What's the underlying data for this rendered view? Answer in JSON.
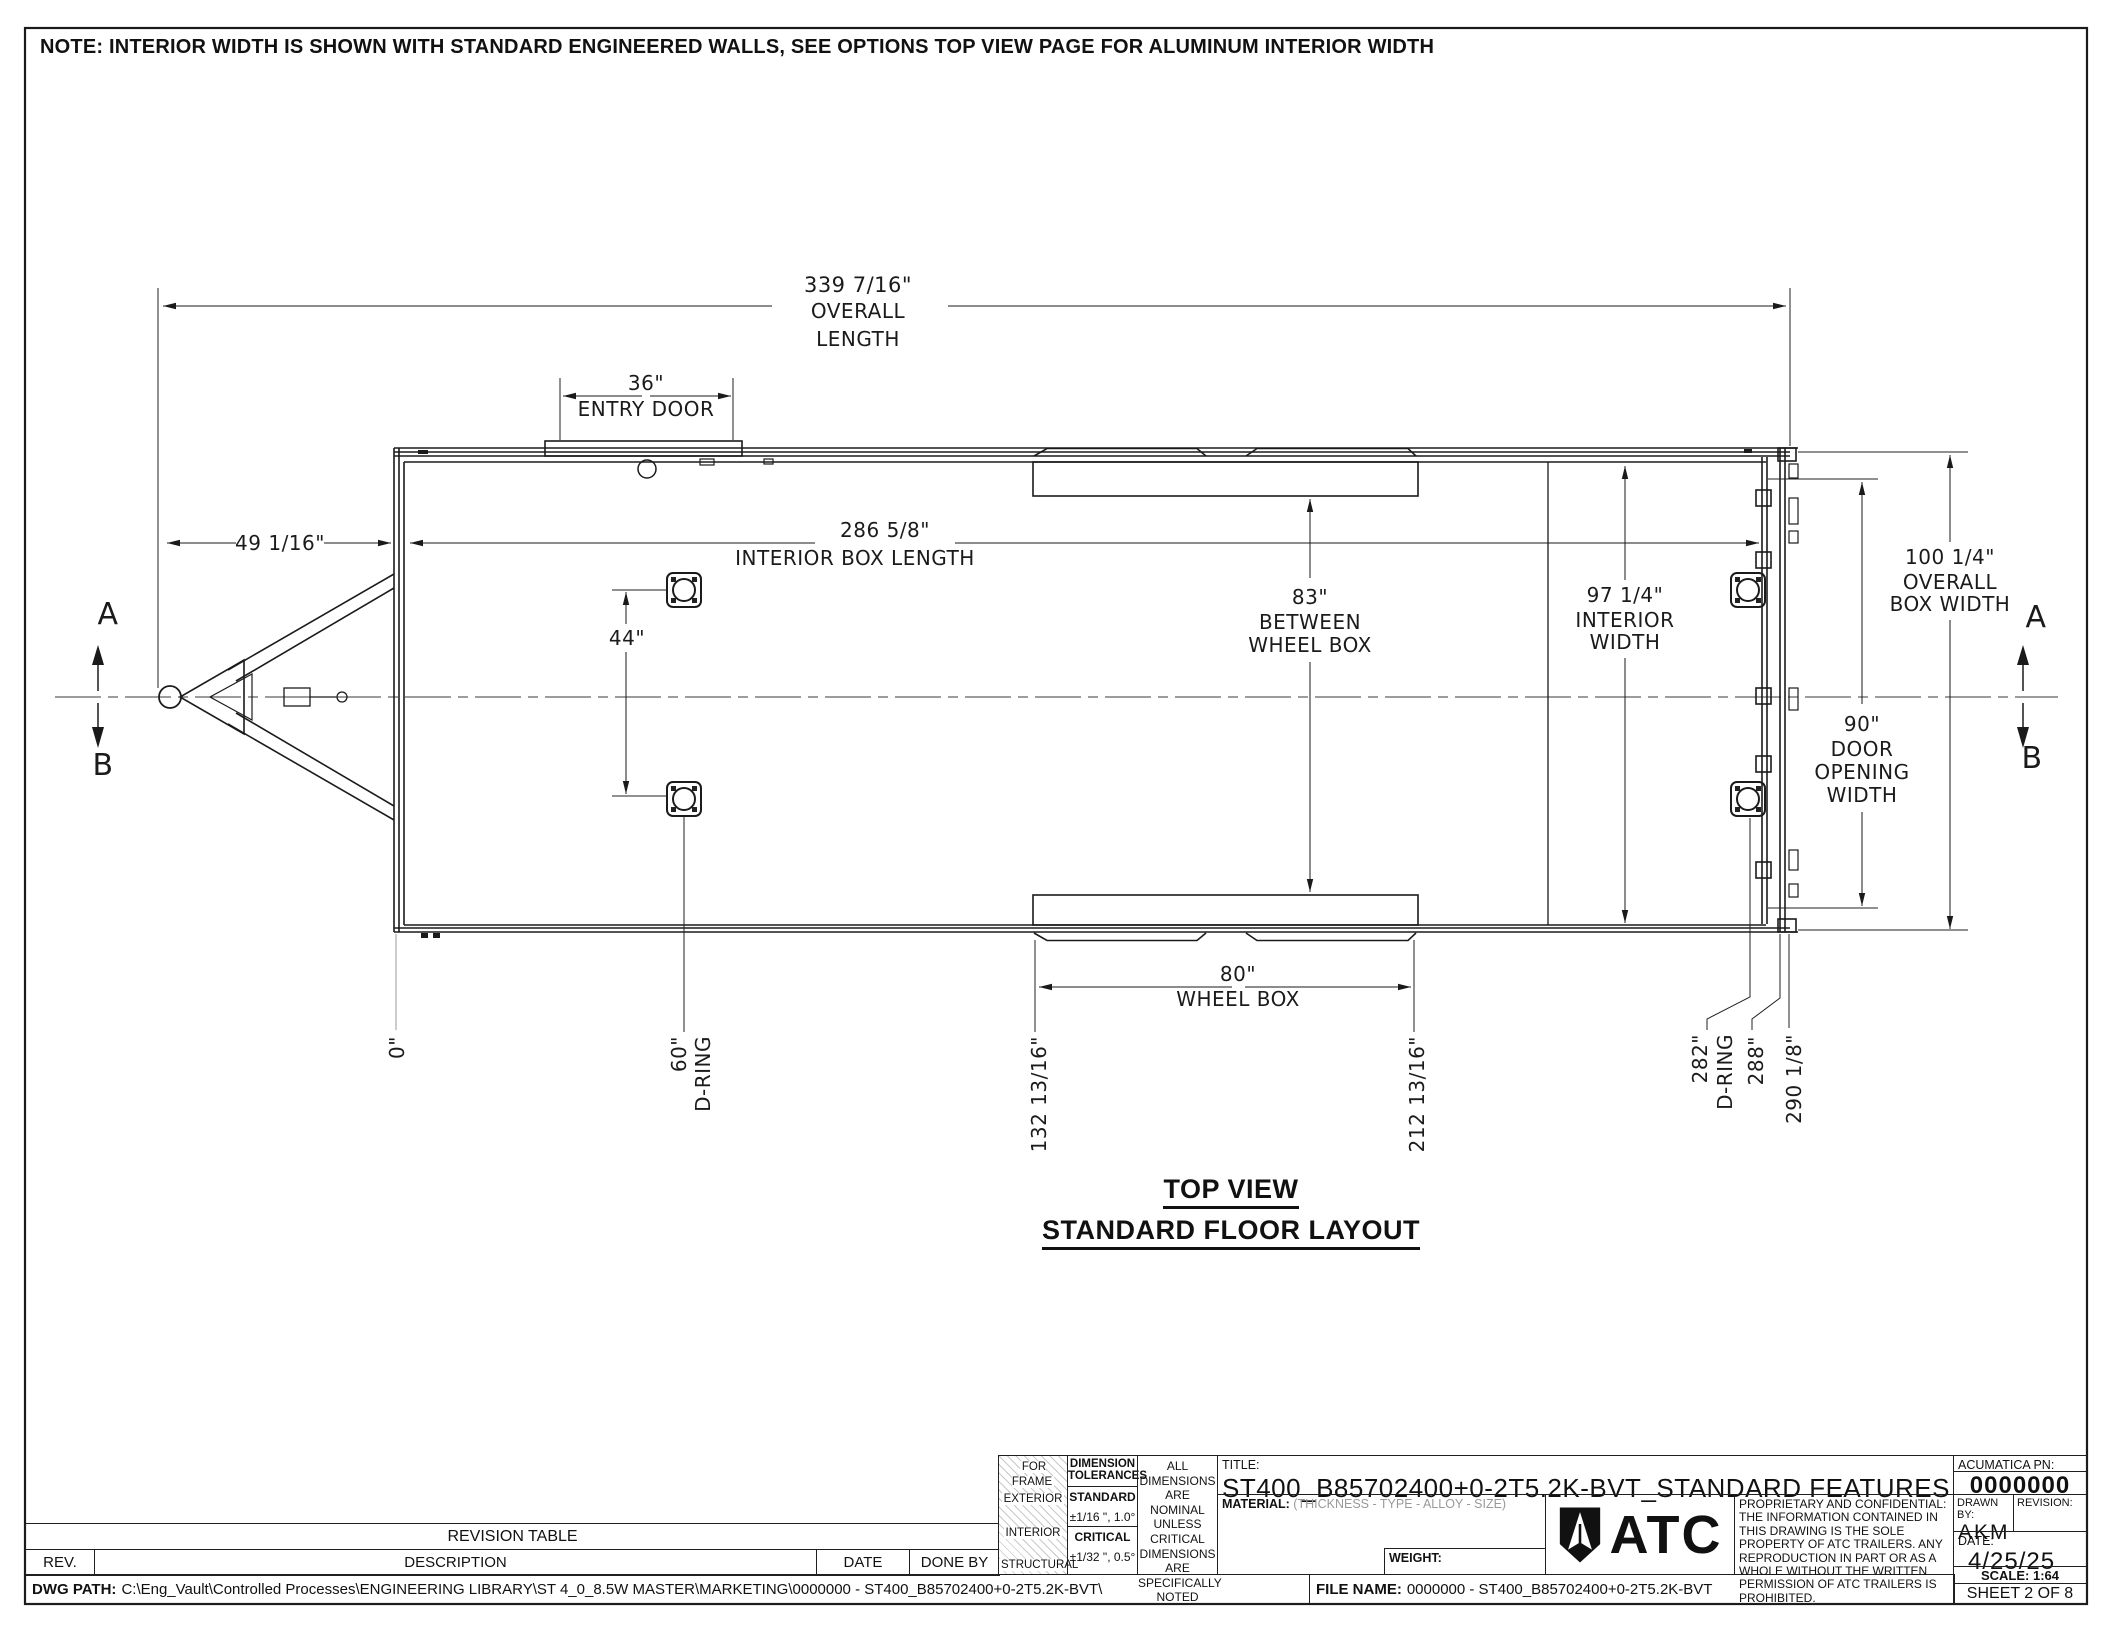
{
  "sheet": {
    "note": "NOTE: INTERIOR WIDTH IS SHOWN WITH STANDARD ENGINEERED WALLS, SEE OPTIONS TOP VIEW PAGE FOR ALUMINUM INTERIOR WIDTH",
    "view_title_line1": "TOP VIEW",
    "view_title_line2": "STANDARD FLOOR LAYOUT"
  },
  "sections": {
    "a": "A",
    "b": "B"
  },
  "dims": {
    "overall_length_value": "339 7/16\"",
    "overall_length_label1": "OVERALL",
    "overall_length_label2": "LENGTH",
    "entry_door_value": "36\"",
    "entry_door_label": "ENTRY DOOR",
    "tongue_value": "49 1/16\"",
    "interior_length_value": "286 5/8\"",
    "interior_length_label": "INTERIOR BOX LENGTH",
    "dring_span_value": "44\"",
    "between_wheelbox_value": "83\"",
    "between_wheelbox_label1": "BETWEEN",
    "between_wheelbox_label2": "WHEEL BOX",
    "interior_width_value": "97 1/4\"",
    "interior_width_label1": "INTERIOR",
    "interior_width_label2": "WIDTH",
    "overall_width_value": "100 1/4\"",
    "overall_width_label1": "OVERALL",
    "overall_width_label2": "BOX WIDTH",
    "door_opening_value": "90\"",
    "door_opening_label1": "DOOR",
    "door_opening_label2": "OPENING",
    "door_opening_label3": "WIDTH",
    "wheelbox_value": "80\"",
    "wheelbox_label": "WHEEL BOX",
    "sta_zero": "0\"",
    "sta_dring_front_value": "60\"",
    "sta_dring_front_label": "D-RING",
    "sta_wheelbox_front": "132 13/16\"",
    "sta_wheelbox_rear": "212 13/16\"",
    "sta_dring_rear_value": "282\"",
    "sta_dring_rear_label": "D-RING",
    "sta_288": "288\"",
    "sta_290": "290 1/8\""
  },
  "revision_table": {
    "title": "REVISION TABLE",
    "col_rev": "REV.",
    "col_desc": "DESCRIPTION",
    "col_date": "DATE",
    "col_done": "DONE BY"
  },
  "footer": {
    "dwg_path_label": "DWG PATH:",
    "dwg_path_value": "C:\\Eng_Vault\\Controlled Processes\\ENGINEERING LIBRARY\\ST 4_0_8.5W MASTER\\MARKETING\\0000000 - ST400_B85702400+0-2T5.2K-BVT\\",
    "file_name_label": "FILE NAME:",
    "file_name_value": "0000000 - ST400_B85702400+0-2T5.2K-BVT",
    "sheet_label": "SHEET 2 OF 8"
  },
  "title_block": {
    "for_frame": "FOR FRAME",
    "frame_row1": "EXTERIOR",
    "frame_row2": "INTERIOR",
    "frame_row3": "STRUCTURAL",
    "tol_header": "DIMENSION TOLERANCES",
    "standard_label": "STANDARD",
    "standard_value": "±1/16 \", 1.0°",
    "critical_label": "CRITICAL",
    "critical_value": "±1/32 \", 0.5°",
    "nominal_note": "ALL DIMENSIONS ARE NOMINAL UNLESS CRITICAL DIMENSIONS ARE SPECIFICALLY NOTED",
    "title_label": "TITLE:",
    "title_value": "ST400_B85702400+0-2T5.2K-BVT_STANDARD FEATURES",
    "material_label": "MATERIAL:",
    "material_value": "(THICKNESS - TYPE - ALLOY - SIZE)",
    "weight_label": "WEIGHT:",
    "logo_text": "ATC",
    "proprietary": "PROPRIETARY AND CONFIDENTIAL: THE INFORMATION CONTAINED IN THIS DRAWING IS THE SOLE PROPERTY OF ATC TRAILERS. ANY REPRODUCTION IN PART OR AS A WHOLE WITHOUT THE WRITTEN PERMISSION OF ATC TRAILERS IS PROHIBITED.",
    "acumatica_label": "ACUMATICA PN:",
    "acumatica_value": "0000000",
    "drawn_by_label": "DRAWN BY:",
    "drawn_by_value": "AKM",
    "revision_label": "REVISION:",
    "date_label": "DATE:",
    "date_value": "4/25/25",
    "scale_label": "SCALE: 1:64"
  }
}
